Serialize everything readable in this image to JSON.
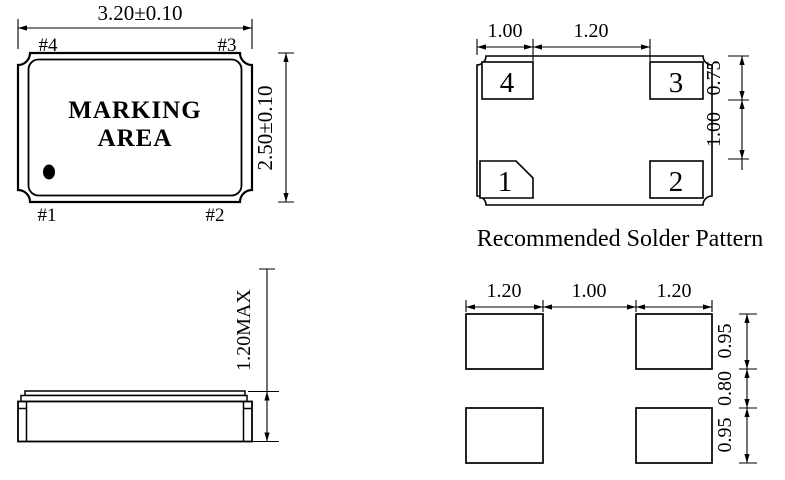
{
  "drawing": {
    "colors": {
      "line": "#000000",
      "background": "#ffffff"
    },
    "top_view": {
      "width_dim": "3.20±0.10",
      "height_dim": "2.50±0.10",
      "marking_line1": "MARKING",
      "marking_line2": "AREA",
      "pin1": "#1",
      "pin2": "#2",
      "pin3": "#3",
      "pin4": "#4"
    },
    "land_pattern_view": {
      "pad1": "1",
      "pad2": "2",
      "pad3": "3",
      "pad4": "4",
      "dim_pad_width": "1.00",
      "dim_pad_gap": "1.20",
      "dim_pad_height": "0.75",
      "dim_row_gap": "1.00",
      "caption": "Recommended Solder Pattern"
    },
    "side_view": {
      "dim_height": "1.20MAX"
    },
    "solder_pattern_view": {
      "dim_left_pad_width": "1.20",
      "dim_col_gap": "1.00",
      "dim_right_pad_width": "1.20",
      "dim_top_pad_height": "0.95",
      "dim_row_gap": "0.80",
      "dim_bottom_pad_height": "0.95"
    }
  }
}
